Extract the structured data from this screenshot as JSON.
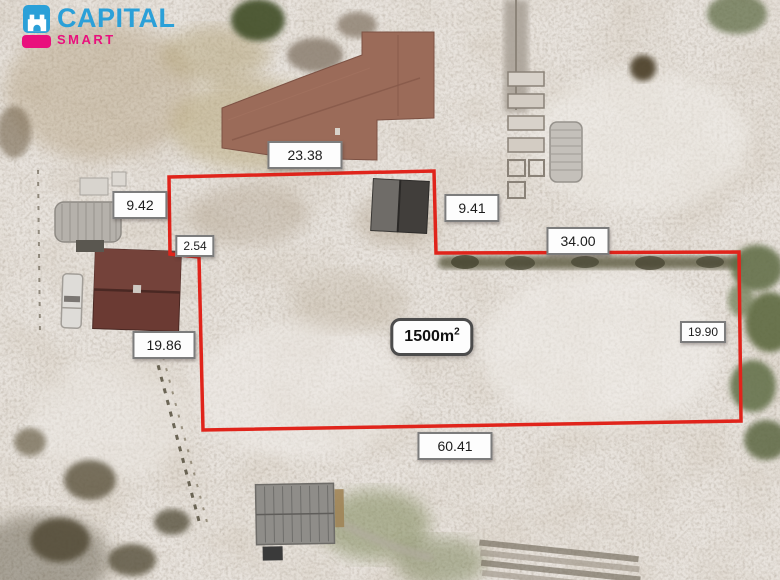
{
  "brand": {
    "name": "CAPITAL",
    "tagline": "SMART",
    "logo_icon": "castle-icon",
    "color_blue": "#2ba0d8",
    "color_pink": "#e9107d"
  },
  "plot": {
    "outline_color": "#e0241b",
    "area": {
      "value": "1500m",
      "superscript": "2"
    },
    "measurements": [
      {
        "edge": "top",
        "value": "23.38"
      },
      {
        "edge": "left-upper",
        "value": "9.42"
      },
      {
        "edge": "step-vertical",
        "value": "9.41"
      },
      {
        "edge": "upper-right",
        "value": "34.00"
      },
      {
        "edge": "left-jog",
        "value": "2.54"
      },
      {
        "edge": "left-lower",
        "value": "19.86"
      },
      {
        "edge": "right",
        "value": "19.90"
      },
      {
        "edge": "bottom",
        "value": "60.41"
      }
    ]
  }
}
